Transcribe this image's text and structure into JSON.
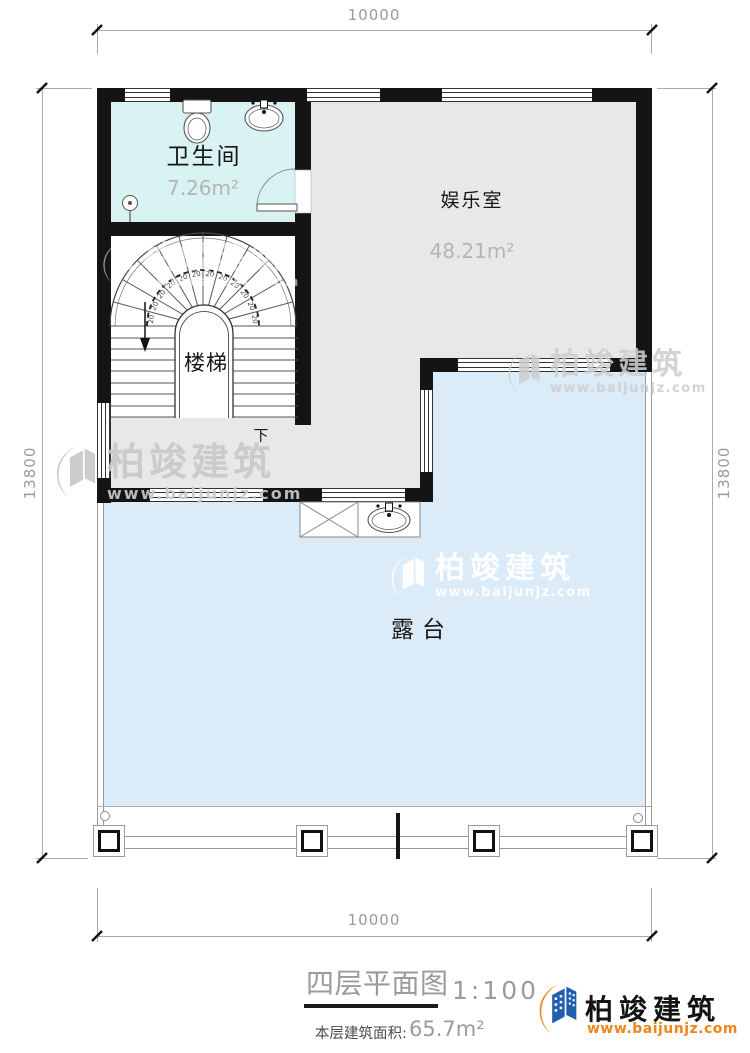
{
  "plan": {
    "rooms": {
      "bathroom": {
        "name": "卫生间",
        "area": "7.26m²"
      },
      "entertainment": {
        "name": "娱乐室",
        "area": "48.21m²"
      },
      "stairwell": {
        "name": "楼梯",
        "direction_label": "下",
        "tread_depth": "20"
      },
      "terrace": {
        "name": "露台"
      }
    },
    "dimensions": {
      "top": "10000",
      "bottom": "10000",
      "left": "13800",
      "right": "13800"
    }
  },
  "title_block": {
    "title": "四层平面图",
    "scale": "1:100",
    "area_label": "本层建筑面积:",
    "area_value": "65.7m²"
  },
  "brand": {
    "name": "柏竣建筑",
    "website": "www.baijunjz.com"
  },
  "colors": {
    "bathroom_fill": "#d9f3f3",
    "room_fill": "#e8e8e8",
    "terrace_fill": "#dcebf8",
    "wall": "#141414",
    "logo_blue": "#1f5fad",
    "logo_orange": "#f08519"
  }
}
